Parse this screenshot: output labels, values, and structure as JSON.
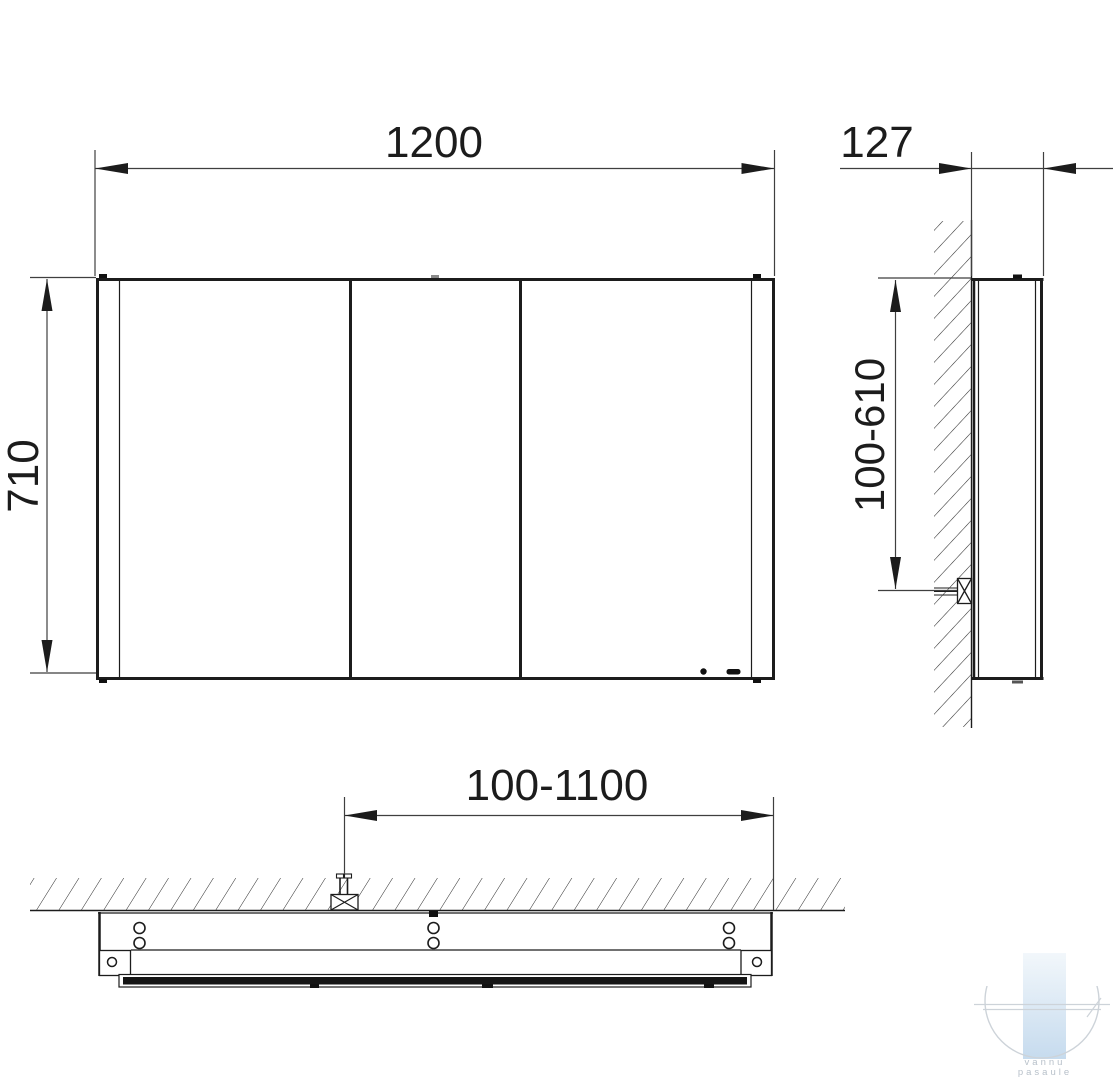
{
  "drawing": {
    "title_present": false,
    "dims": {
      "width": "1200",
      "depth": "127",
      "height": "710",
      "mount_height": "100-610",
      "mount_offset": "100-1100"
    },
    "views": {
      "front": "front-view-three-door-mirror-cabinet",
      "side": "side-view-wall-mounted",
      "bottom": "bottom-plan-view-wall-mounted"
    },
    "colors": {
      "line": "#1c1c1c",
      "dimension_line": "#3f3f3f",
      "watermark_bar_top": "#f2f7fb",
      "watermark_bar_bottom": "#c6dbee",
      "watermark_gray": "#cdd3d9",
      "watermark_text": "#b8c1ca"
    },
    "watermark": {
      "line1": "vannu",
      "line2": "pasaule"
    }
  }
}
